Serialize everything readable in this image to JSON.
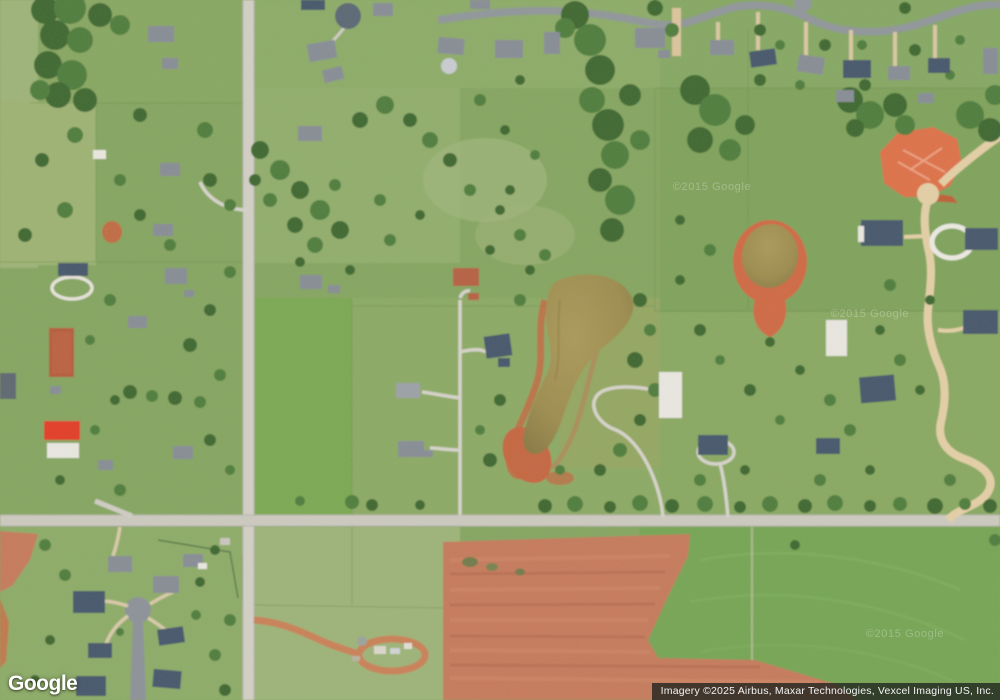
{
  "map": {
    "view_type": "satellite",
    "logo_text": "Google",
    "attribution_text": "Imagery ©2025 Airbus, Maxar Technologies, Vexcel Imaging US, Inc.",
    "watermark_text": "©2015 Google"
  },
  "palette": {
    "grass-base": "#84a45e",
    "grass-bright": "#7aa851",
    "grass-dark": "#74a453",
    "grass-pale": "#9cb377",
    "tree-dark": "#3c662e",
    "tree-mid": "#4e7c3a",
    "road-light": "#d2cfc5",
    "road-asphalt": "#8f959a",
    "road-tan": "#e4cfa5",
    "dirt-red": "#c5795a",
    "dirt-bright": "#dd6f47",
    "pond-water": "#9c8b4d",
    "roof-red": "#e23b28",
    "roof-dark": "#45546a",
    "roof-gray": "#868c94",
    "building-white": "#e9e7e0"
  }
}
